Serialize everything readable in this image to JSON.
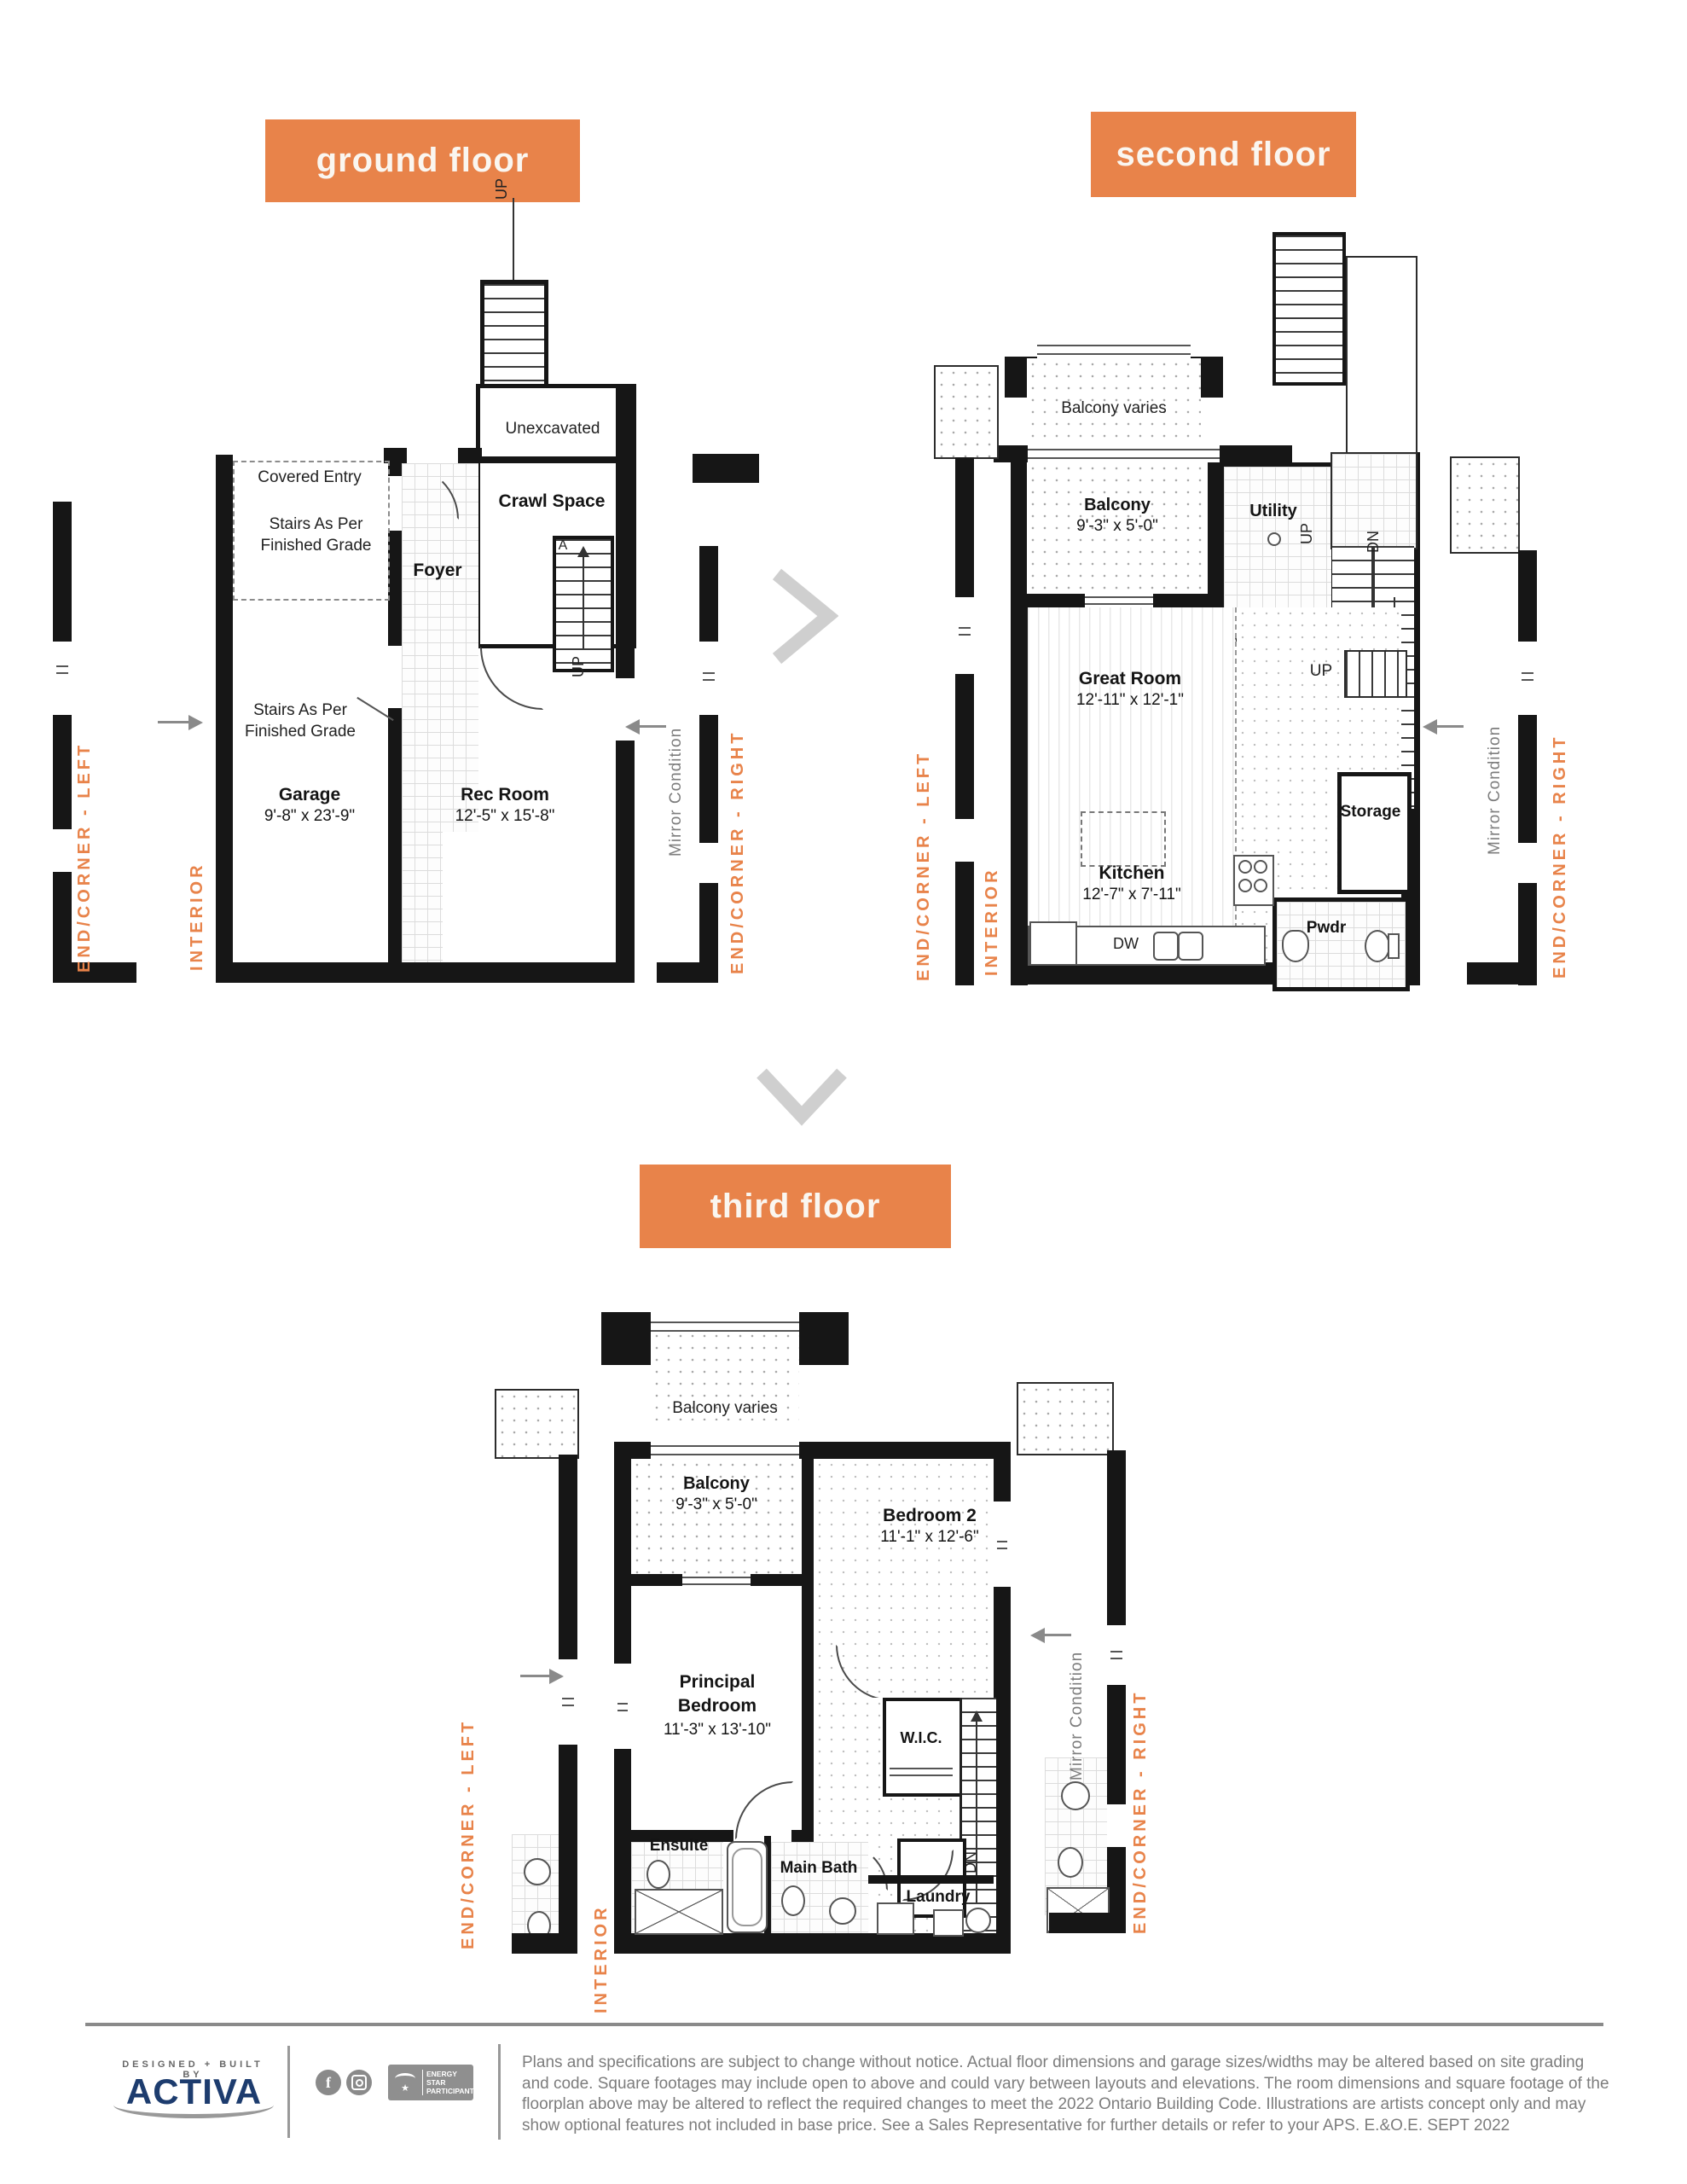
{
  "colors": {
    "accent_orange": "#E8834A",
    "navy": "#1D3C6E",
    "wall_black": "#161616",
    "gray_text": "#7A7A7A",
    "chevron_gray": "#CFCFCF"
  },
  "headers": {
    "ground": "ground floor",
    "second": "second floor",
    "third": "third floor"
  },
  "orient": {
    "end_corner_left": "END/CORNER - LEFT",
    "end_corner_right": "END/CORNER - RIGHT",
    "interior": "INTERIOR",
    "mirror_condition": "Mirror Condition"
  },
  "shared": {
    "up": "UP",
    "dn": "DN",
    "balcony_varies": "Balcony varies",
    "balcony": "Balcony",
    "balcony_dims": "9'-3\" x 5'-0\"",
    "wic": "W.I.C."
  },
  "ground_floor": {
    "unexcavated": "Unexcavated",
    "covered_entry": "Covered Entry",
    "stairs_note_line1": "Stairs As Per",
    "stairs_note_line2": "Finished Grade",
    "foyer": "Foyer",
    "crawl_space": "Crawl Space",
    "stair_section_mark": "A",
    "garage": "Garage",
    "garage_dims": "9'-8\" x 23'-9\"",
    "rec_room": "Rec Room",
    "rec_room_dims": "12'-5\" x 15'-8\""
  },
  "second_floor": {
    "utility": "Utility",
    "half_wall": "Half Wall",
    "great_room": "Great Room",
    "great_room_dims": "12'-11\" x 12'-1\"",
    "kitchen": "Kitchen",
    "kitchen_dims": "12'-7\" x 7'-11\"",
    "dw": "DW",
    "storage": "Storage",
    "pwdr": "Pwdr"
  },
  "third_floor": {
    "bedroom2": "Bedroom 2",
    "bedroom2_dims": "11'-1\" x 12'-6\"",
    "principal_line1": "Principal",
    "principal_line2": "Bedroom",
    "principal_dims": "11'-3\" x 13'-10\"",
    "linen": "Linen",
    "ensuite": "Ensuite",
    "main_bath": "Main Bath",
    "laundry": "Laundry"
  },
  "footer": {
    "designed_built": "DESIGNED + BUILT BY",
    "brand": "ACTIVA",
    "energy_star": "ENERGY STAR PARTICIPANT",
    "disclaimer": "Plans and specifications are subject to change without notice. Actual floor dimensions and garage sizes/widths may be altered based on site grading and code. Square footages may include open to above and could vary between layouts and elevations. The room dimensions and square footage of the floorplan above may be altered to reflect the required changes to meet the 2022 Ontario Building Code. Illustrations are artists concept only and may show optional features not included in base price. See a Sales Representative for further details or refer to your APS. E.&O.E. SEPT 2022"
  }
}
